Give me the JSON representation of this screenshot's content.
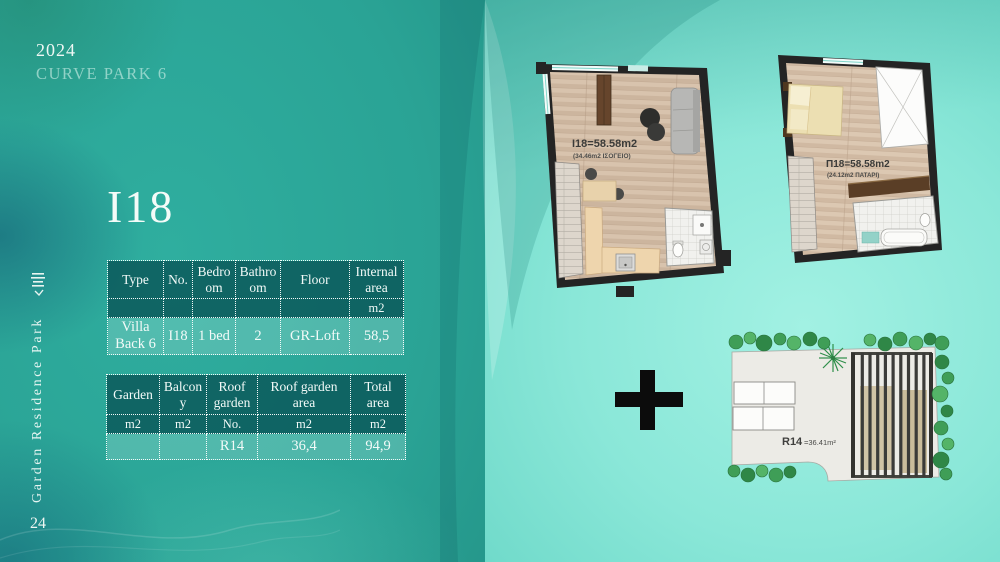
{
  "header": {
    "year": "2024",
    "project": "CURVE PARK 6"
  },
  "sidebar": {
    "brand": "Garden Residence Park",
    "page": "24"
  },
  "unit": {
    "title": "I18"
  },
  "spec_table": {
    "headers": [
      "Type",
      "No.",
      "Bedroom",
      "Bathroom",
      "Floor",
      "Internal area"
    ],
    "units": [
      "",
      "",
      "",
      "",
      "",
      "m2"
    ],
    "row": [
      "Villa Back 6",
      "I18",
      "1 bed",
      "2",
      "GR-Loft",
      "58,5"
    ]
  },
  "area_table": {
    "headers": [
      "Garden",
      "Balcony",
      "Roof garden",
      "Roof garden area",
      "Total area"
    ],
    "units": [
      "m2",
      "m2",
      "No.",
      "m2",
      "m2"
    ],
    "row": [
      "",
      "",
      "R14",
      "36,4",
      "94,9"
    ]
  },
  "plans": {
    "ground_floor": {
      "label": "I18=58.58m2",
      "sublabel": "(34.46m2 ΙΣΟΓΕΙΟ)"
    },
    "loft": {
      "label": "Π18=58.58m2",
      "sublabel": "(24.12m2 ΠΑΤΑΡΙ)"
    },
    "roof_garden": {
      "label": "R14",
      "area_label": "=36.41m²"
    }
  },
  "icons": {
    "plus_between_plans": "plus-icon",
    "brand_logo": "brand-logo-icon"
  },
  "colors": {
    "left_bg": "#2aa395",
    "right_bg": "#7fe0d0",
    "table_header_bg": "#095456",
    "wall": "#242424",
    "wood": "#d3bda6",
    "garden_green": "#3f9e57",
    "accent_text": "#f2faf8"
  }
}
